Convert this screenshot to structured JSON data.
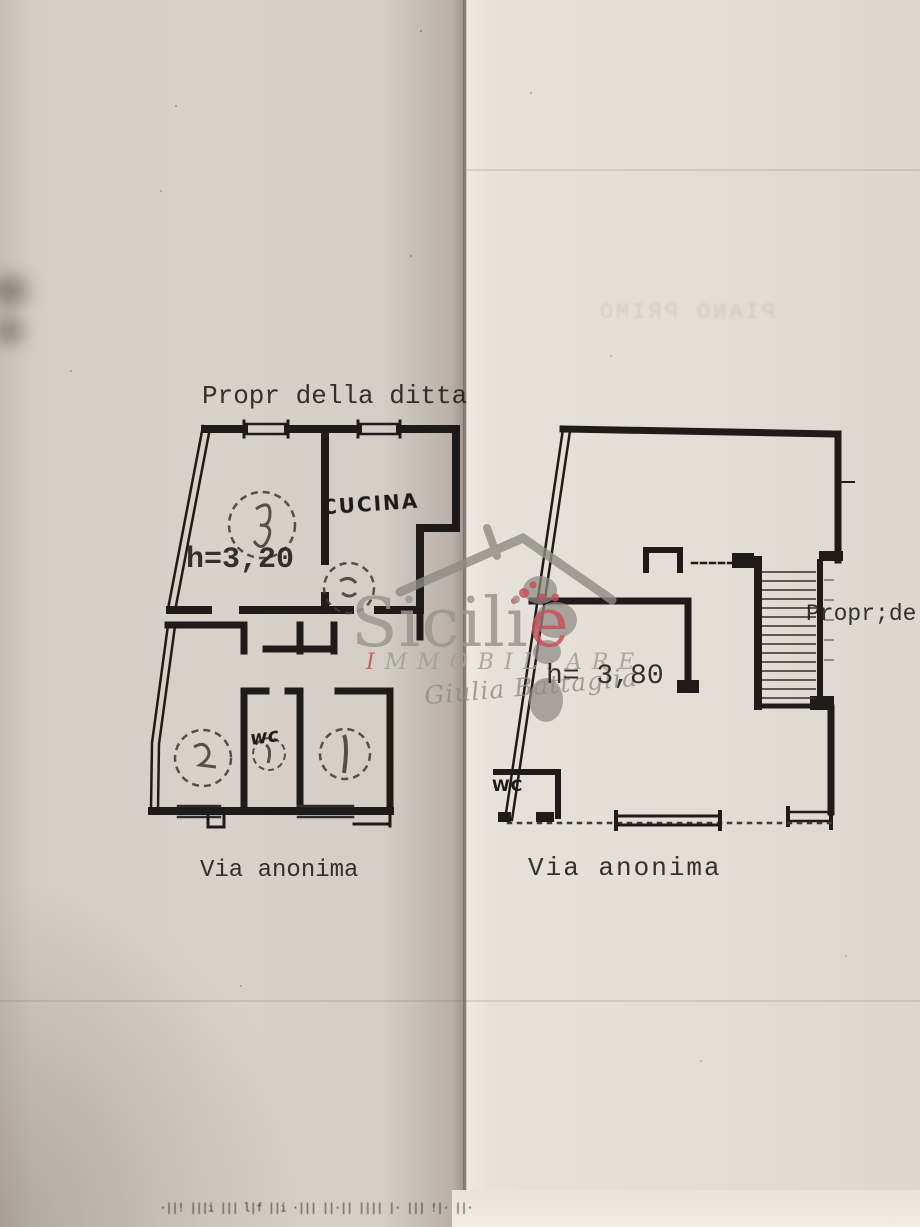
{
  "scan": {
    "bleedthrough_text": "PIANO PRIMO",
    "footer_smudge": "·||! |||i ||| l|f ||i ·||| ||·|| |||| |· ||| !|· ||·"
  },
  "left_plan": {
    "title": "Propr della ditta",
    "height_label": "h=3,20",
    "kitchen_label": "CUCINA",
    "wc_label": "wc",
    "street_label": "Via anonima"
  },
  "right_plan": {
    "height_label": "h= 3,80",
    "wc_label": "WC",
    "street_label": "Via anonima",
    "owner_label": "Propr;de"
  },
  "watermark": {
    "brand_main": "Sicili",
    "brand_accent": "ë",
    "subtitle_first": "I",
    "subtitle_rest": "MMOBILIARE",
    "signature": "Giulia Battaglia",
    "gray_color": "#9b968e",
    "accent_color": "#c9525b"
  }
}
